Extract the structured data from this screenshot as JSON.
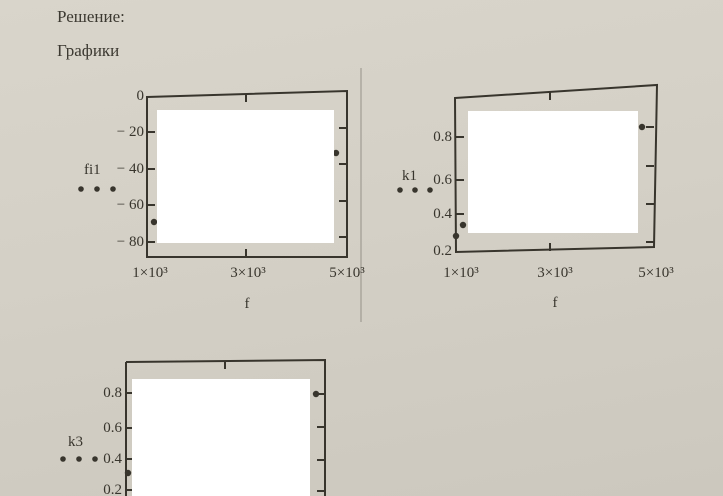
{
  "page": {
    "heading": "Решение:",
    "subheading": "Графики"
  },
  "colors": {
    "paper": "#d4d0c6",
    "ink": "#38352d",
    "redaction": "#ffffff",
    "divider": "#97938a"
  },
  "chart_data": [
    {
      "id": "fi1-vs-f",
      "type": "scatter",
      "legend": {
        "label": "fi1",
        "marker": "three-dot-line"
      },
      "xlabel": "f",
      "x_tick_labels": [
        "1×10³",
        "3×10³",
        "5×10³"
      ],
      "x_tick_values": [
        1000,
        3000,
        5000
      ],
      "y_tick_labels": [
        "0",
        "− 20",
        "− 40",
        "− 60",
        "− 80"
      ],
      "y_tick_values": [
        0,
        -20,
        -40,
        -60,
        -80
      ],
      "xlim": [
        1000,
        5200
      ],
      "ylim": [
        -88,
        0
      ],
      "grid": false,
      "legend_position": "left",
      "visible_points": [
        {
          "f": 1100,
          "fi1": -69
        },
        {
          "f": 4800,
          "fi1": -31
        }
      ],
      "note": "plot interior hidden by white redaction rectangle"
    },
    {
      "id": "k1-vs-f",
      "type": "scatter",
      "legend": {
        "label": "k1",
        "marker": "three-dot-line"
      },
      "xlabel": "f",
      "x_tick_labels": [
        "1×10³",
        "3×10³",
        "5×10³"
      ],
      "x_tick_values": [
        1000,
        3000,
        5000
      ],
      "y_tick_labels": [
        "0.8",
        "0.6",
        "0.4",
        "0.2"
      ],
      "y_tick_values": [
        0.8,
        0.6,
        0.4,
        0.2
      ],
      "xlim": [
        1000,
        5200
      ],
      "ylim": [
        0.2,
        0.93
      ],
      "grid": false,
      "legend_position": "left",
      "visible_points": [
        {
          "f": 1000,
          "k1": 0.28
        },
        {
          "f": 1040,
          "k1": 0.34
        },
        {
          "f": 4700,
          "k1": 0.85
        }
      ],
      "note": "plot interior hidden by white redaction rectangle"
    },
    {
      "id": "k3-vs-f",
      "type": "scatter",
      "legend": {
        "label": "k3",
        "marker": "three-dot-line"
      },
      "y_tick_labels": [
        "0.8",
        "0.6",
        "0.4",
        "0.2"
      ],
      "y_tick_values": [
        0.8,
        0.6,
        0.4,
        0.2
      ],
      "ylim": [
        0.2,
        0.93
      ],
      "grid": false,
      "legend_position": "left",
      "visible_points": [
        {
          "f": 1000,
          "k3": 0.31
        },
        {
          "f": 4800,
          "k3": 0.8
        }
      ],
      "note": "plot interior hidden by white redaction rectangle; bottom of plot cropped by image edge"
    }
  ]
}
